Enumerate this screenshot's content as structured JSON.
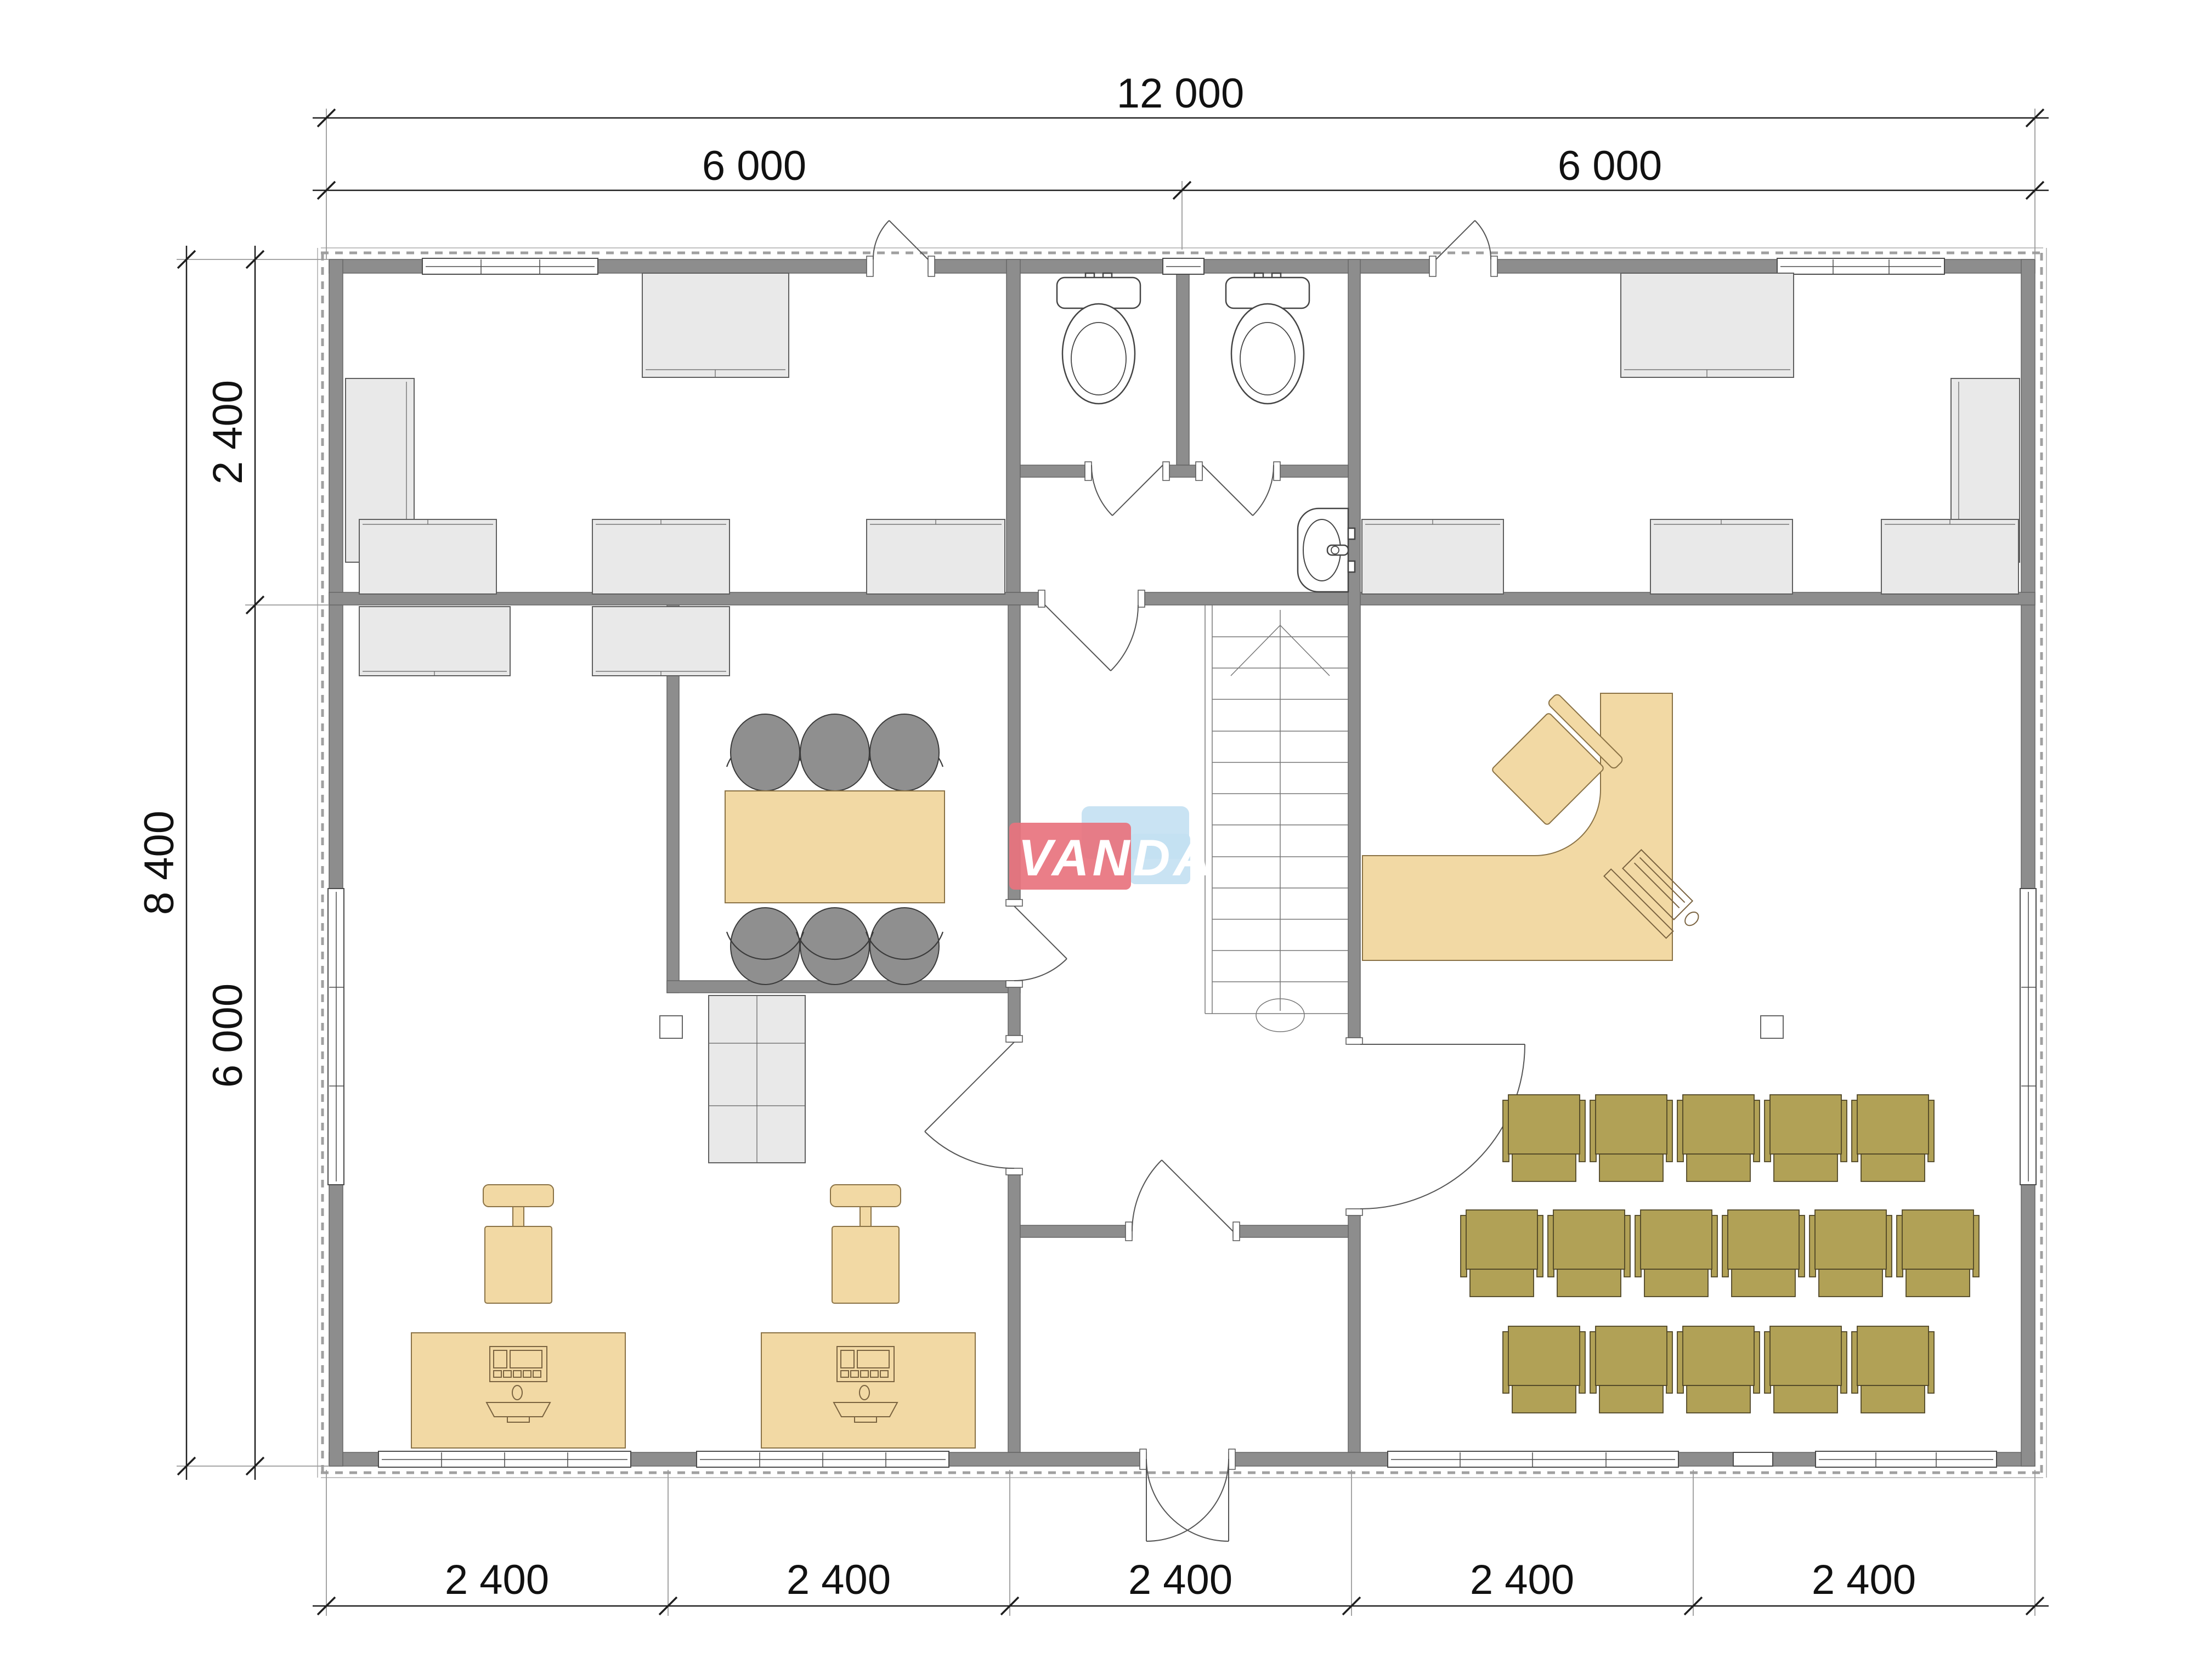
{
  "watermark": {
    "text": "VANDA"
  },
  "dimensions": {
    "top_total": "12 000",
    "top_left": "6 000",
    "top_right": "6 000",
    "side_total": "8 400",
    "side_upper": "2 400",
    "side_lower": "6 000",
    "bottom_1": "2 400",
    "bottom_2": "2 400",
    "bottom_3": "2 400",
    "bottom_4": "2 400",
    "bottom_5": "2 400"
  },
  "colors": {
    "wall": "#8d8d8d",
    "cabinet": "#e9e9e9",
    "tan": "#f2d9a4",
    "olive": "#b1a156",
    "chair_gray": "#8f8f8f",
    "logo_red": "#e8737e",
    "logo_blue": "#c3e0f2",
    "dim": "#1f1f1f"
  },
  "icons": {
    "toilet": "toilet-icon",
    "sink": "sink-icon",
    "stairs_arrow": "stairs-up-arrow-icon",
    "computer": "computer-icon"
  }
}
